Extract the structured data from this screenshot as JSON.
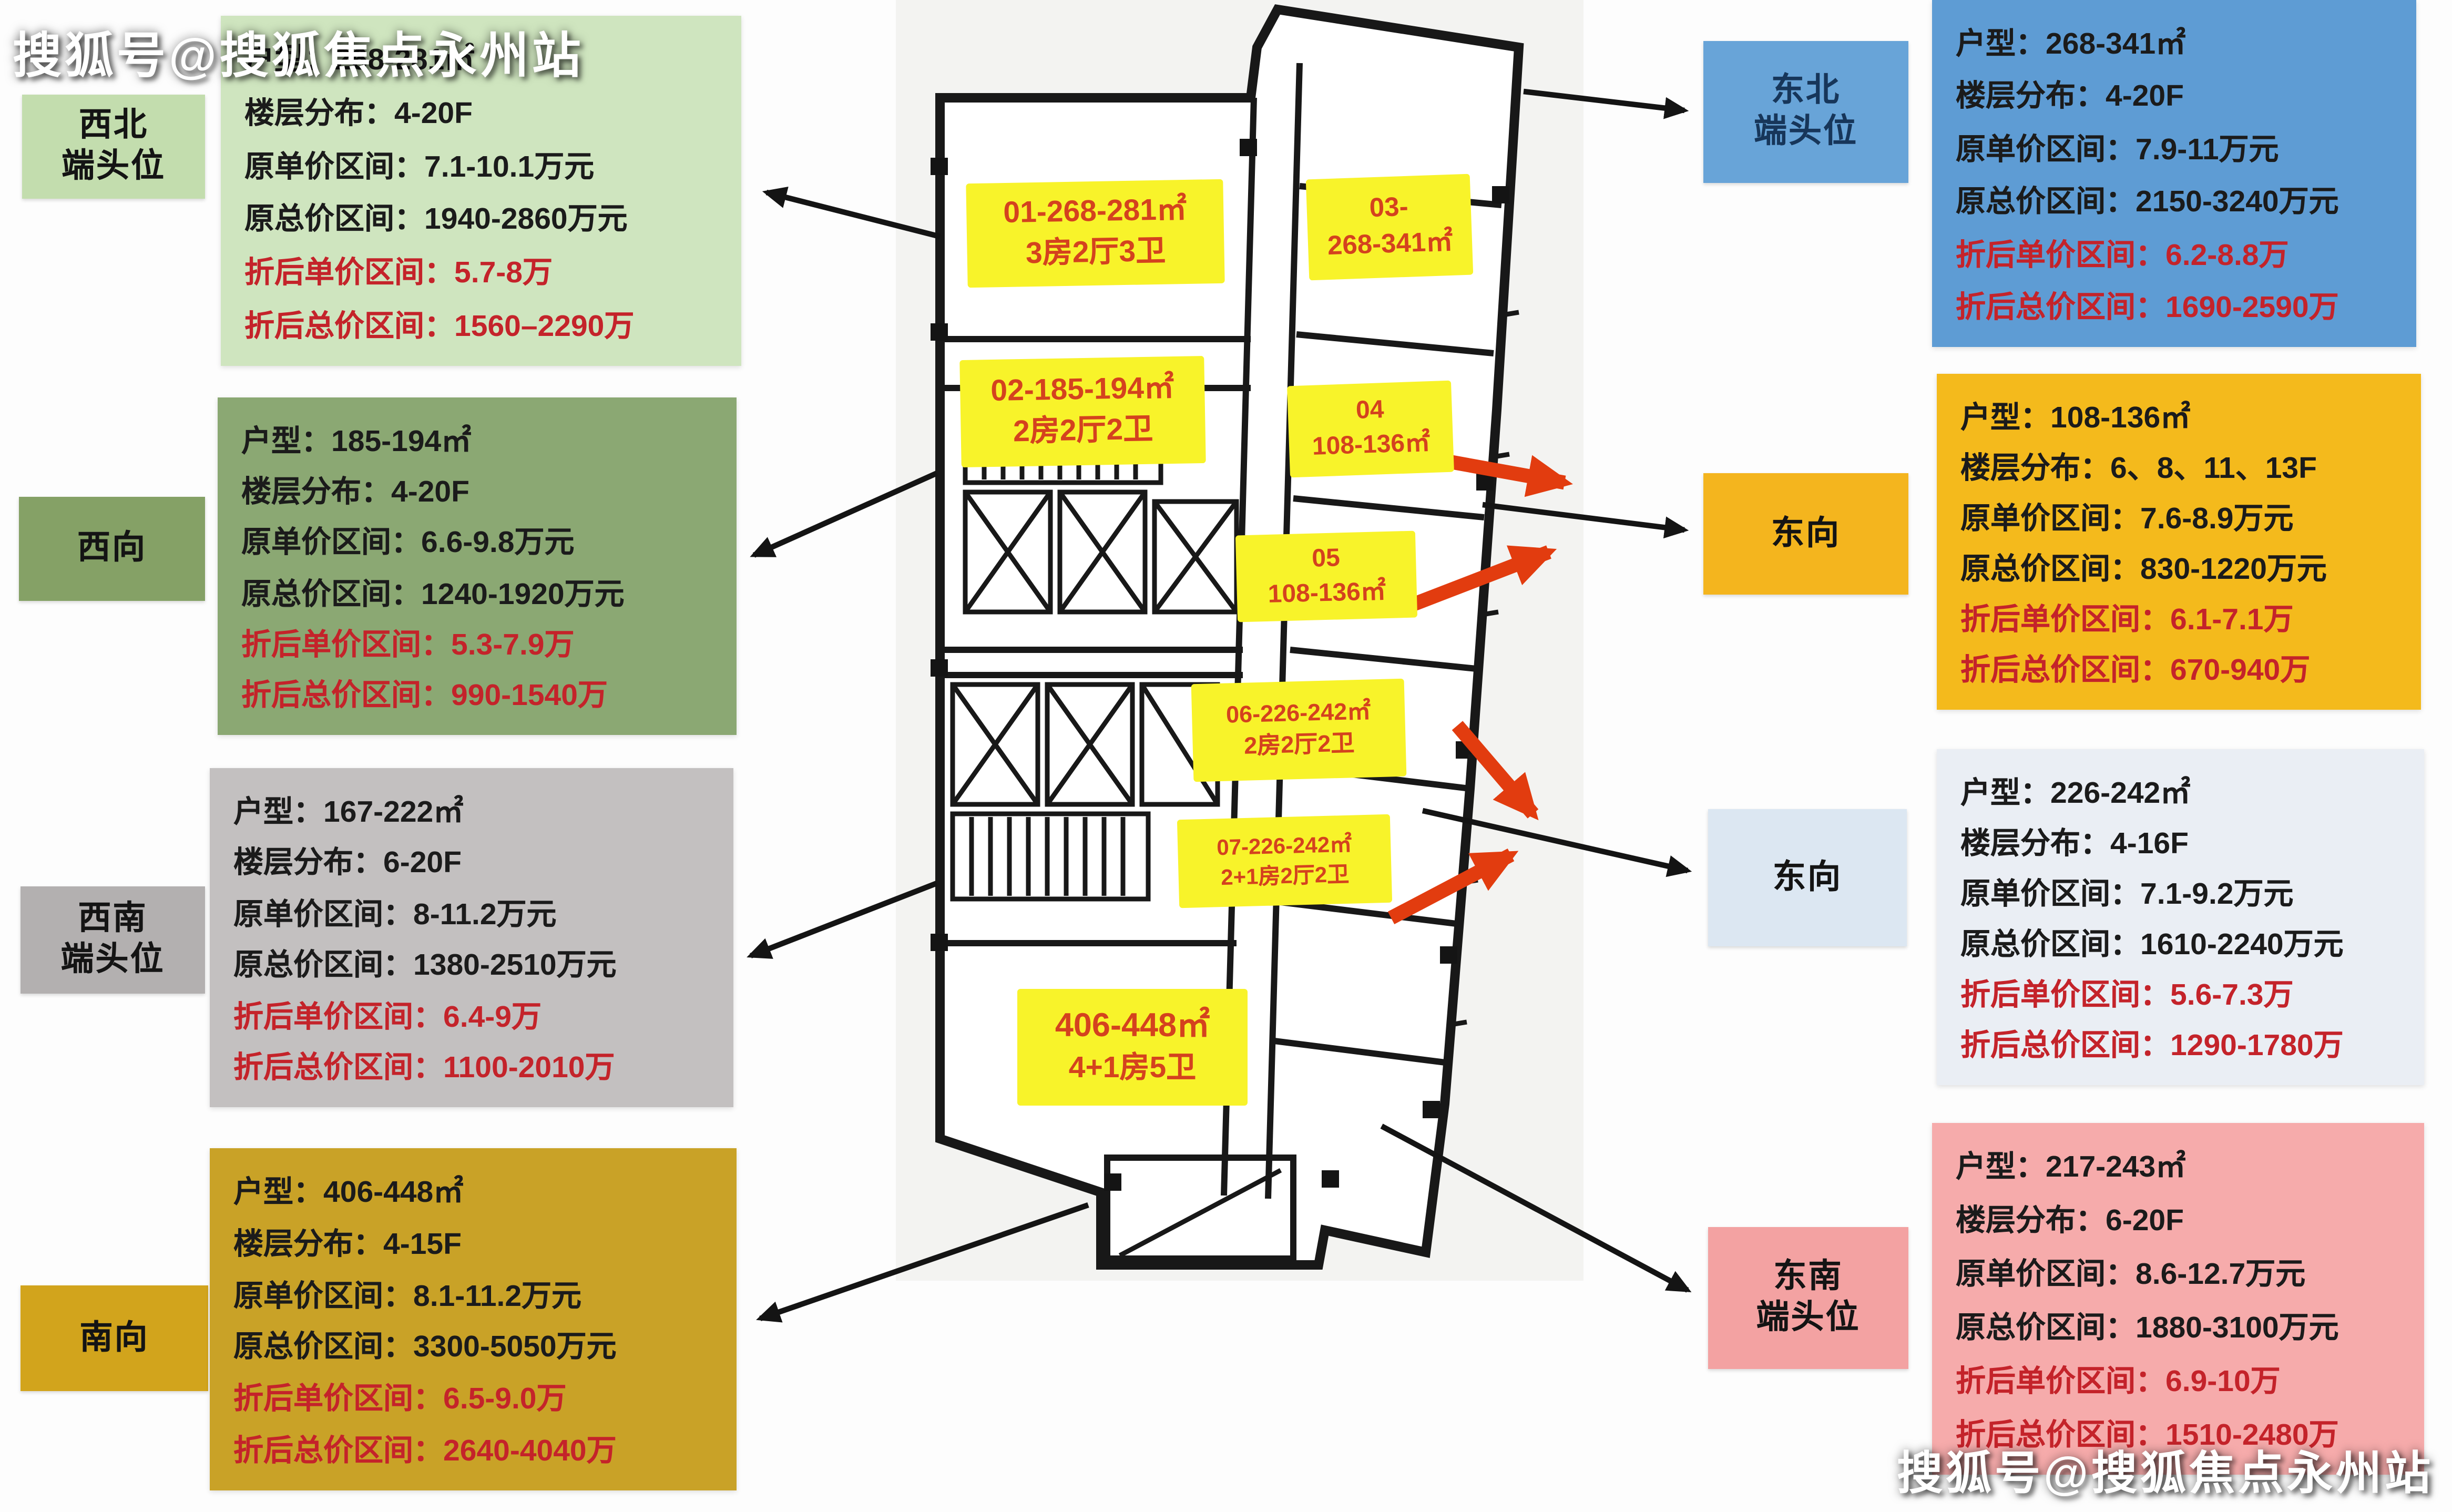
{
  "watermark": {
    "top_left": "搜狐号@搜狐焦点永州站",
    "bottom_right": "搜狐号@搜狐焦点永州站"
  },
  "field_labels": {
    "area": "户型：",
    "floors": "楼层分布：",
    "unit_price": "原单价区间：",
    "total_price": "原总价区间：",
    "disc_unit": "折后单价区间：",
    "disc_total": "折后总价区间："
  },
  "colors": {
    "unit_label_bg": "#f8f32a",
    "unit_label_text": "#d4421e",
    "arrow_black": "#141414",
    "arrow_red": "#e23c0f",
    "discount_text": "#c4232a"
  },
  "cards": [
    {
      "id": "northwest-end",
      "tag_line1": "西北",
      "tag_line2": "端头位",
      "colors": {
        "tag_bg": "#c3ddae",
        "tag_text": "#141414",
        "card_bg": "#cfe5bf"
      },
      "values": {
        "area": "268-281㎡",
        "floors": "4-20F",
        "unit_price": "7.1-10.1万元",
        "total_price": "1940-2860万元",
        "disc_unit": "5.7-8万",
        "disc_total": "1560–2290万"
      }
    },
    {
      "id": "west",
      "tag_line1": "西向",
      "tag_line2": "",
      "colors": {
        "tag_bg": "#85a166",
        "tag_text": "#141414",
        "card_bg": "#8ba873"
      },
      "values": {
        "area": "185-194㎡",
        "floors": "4-20F",
        "unit_price": "6.6-9.8万元",
        "total_price": "1240-1920万元",
        "disc_unit": "5.3-7.9万",
        "disc_total": "990-1540万"
      }
    },
    {
      "id": "southwest-end",
      "tag_line1": "西南",
      "tag_line2": "端头位",
      "colors": {
        "tag_bg": "#b3b0b0",
        "tag_text": "#141414",
        "card_bg": "#c3c0c0"
      },
      "values": {
        "area": "167-222㎡",
        "floors": "6-20F",
        "unit_price": "8-11.2万元",
        "total_price": "1380-2510万元",
        "disc_unit": "6.4-9万",
        "disc_total": "1100-2010万"
      }
    },
    {
      "id": "south",
      "tag_line1": "南向",
      "tag_line2": "",
      "colors": {
        "tag_bg": "#d2a41c",
        "tag_text": "#141414",
        "card_bg": "#c9a227"
      },
      "values": {
        "area": "406-448㎡",
        "floors": "4-15F",
        "unit_price": "8.1-11.2万元",
        "total_price": "3300-5050万元",
        "disc_unit": "6.5-9.0万",
        "disc_total": "2640-4040万"
      }
    },
    {
      "id": "northeast-end",
      "tag_line1": "东北",
      "tag_line2": "端头位",
      "colors": {
        "tag_bg": "#68a4d8",
        "tag_text": "#17365a",
        "card_bg": "#5e9cd4"
      },
      "values": {
        "area": "268-341㎡",
        "floors": "4-20F",
        "unit_price": "7.9-11万元",
        "total_price": "2150-3240万元",
        "disc_unit": "6.2-8.8万",
        "disc_total": "1690-2590万"
      }
    },
    {
      "id": "east-upper",
      "tag_line1": "东向",
      "tag_line2": "",
      "colors": {
        "tag_bg": "#f4b51e",
        "tag_text": "#141414",
        "card_bg": "#f4ba1c"
      },
      "values": {
        "area": "108-136㎡",
        "floors": "6、8、11、13F",
        "unit_price": "7.6-8.9万元",
        "total_price": "830-1220万元",
        "disc_unit": "6.1-7.1万",
        "disc_total": "670-940万"
      }
    },
    {
      "id": "east-lower",
      "tag_line1": "东向",
      "tag_line2": "",
      "colors": {
        "tag_bg": "#dce7f2",
        "tag_text": "#141414",
        "card_bg": "#eaeef4"
      },
      "values": {
        "area": "226-242㎡",
        "floors": "4-16F",
        "unit_price": "7.1-9.2万元",
        "total_price": "1610-2240万元",
        "disc_unit": "5.6-7.3万",
        "disc_total": "1290-1780万"
      }
    },
    {
      "id": "southeast-end",
      "tag_line1": "东南",
      "tag_line2": "端头位",
      "colors": {
        "tag_bg": "#f3a2a2",
        "tag_text": "#141414",
        "card_bg": "#f6abab"
      },
      "values": {
        "area": "217-243㎡",
        "floors": "6-20F",
        "unit_price": "8.6-12.7万元",
        "total_price": "1880-3100万元",
        "disc_unit": "6.9-10万",
        "disc_total": "1510-2480万"
      }
    }
  ],
  "plan_units": [
    {
      "id": "01",
      "line1": "01-268-281㎡",
      "line2": "3房2厅3卫"
    },
    {
      "id": "02",
      "line1": "02-185-194㎡",
      "line2": "2房2厅2卫"
    },
    {
      "id": "03",
      "line1": "03-",
      "line2": "268-341㎡"
    },
    {
      "id": "04",
      "line1": "04",
      "line2": "108-136㎡"
    },
    {
      "id": "05",
      "line1": "05",
      "line2": "108-136㎡"
    },
    {
      "id": "06",
      "line1": "06-226-242㎡",
      "line2": "2房2厅2卫"
    },
    {
      "id": "07",
      "line1": "07-226-242㎡",
      "line2": "2+1房2厅2卫"
    },
    {
      "id": "penthouse",
      "line1": "406-448㎡",
      "line2": "4+1房5卫"
    }
  ]
}
